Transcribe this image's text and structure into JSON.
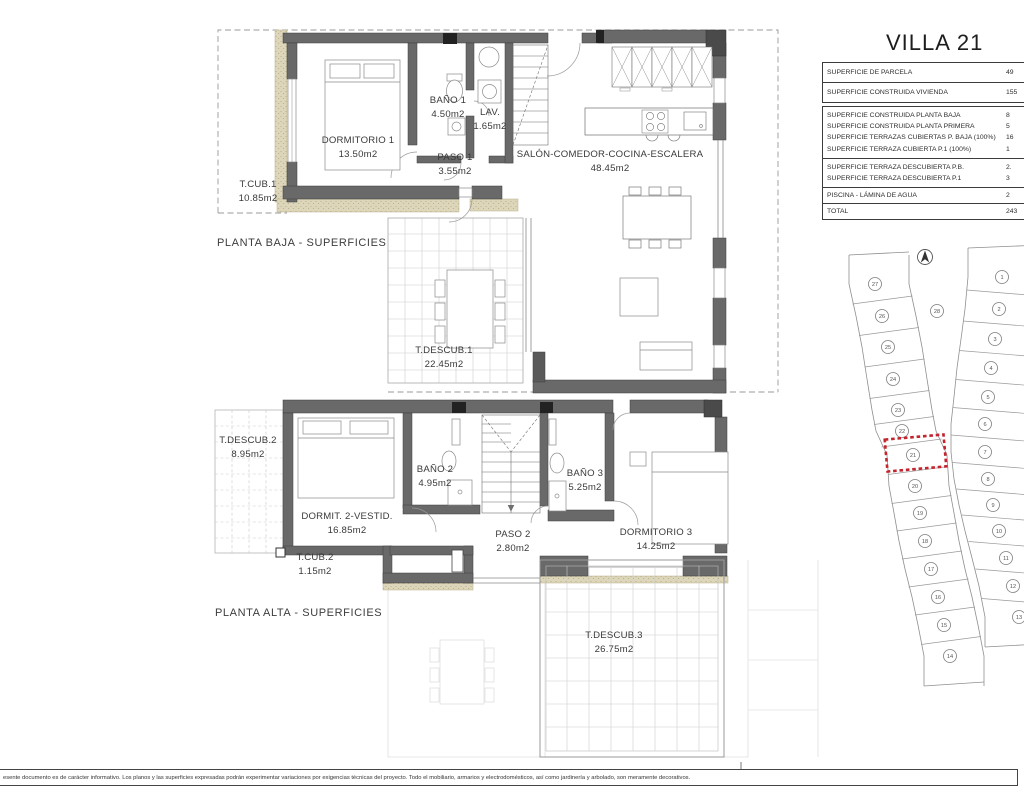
{
  "title": "VILLA 21",
  "table": {
    "rows_main": [
      {
        "label": "SUPERFICIE DE PARCELA",
        "value": "49"
      },
      {
        "label": "SUPERFICIE CONSTRUIDA VIVIENDA",
        "value": "155"
      }
    ],
    "rows_construida": [
      {
        "label": "SUPERFICIE CONSTRUIDA PLANTA BAJA",
        "value": "8"
      },
      {
        "label": "SUPERFICIE CONSTRUIDA PLANTA PRIMERA",
        "value": "5"
      },
      {
        "label": "SUPERFICIE TERRAZAS CUBIERTAS P. BAJA (100%)",
        "value": "16"
      },
      {
        "label": "SUPERFICIE TERRAZA CUBIERTA P.1 (100%)",
        "value": "1"
      }
    ],
    "rows_descubierta": [
      {
        "label": "SUPERFICIE TERRAZA DESCUBIERTA P.B.",
        "value": "2."
      },
      {
        "label": "SUPERFICIE TERRAZA DESCUBIERTA P.1",
        "value": "3"
      }
    ],
    "rows_piscina": [
      {
        "label": "PISCINA - LÁMINA DE AGUA",
        "value": "2"
      }
    ],
    "rows_total": [
      {
        "label": "TOTAL",
        "value": "243"
      }
    ]
  },
  "floors": {
    "baja": {
      "caption": "PLANTA BAJA - SUPERFICIES",
      "rooms": [
        {
          "name": "DORMITORIO 1",
          "area": "13.50m2"
        },
        {
          "name": "BAÑO 1",
          "area": "4.50m2"
        },
        {
          "name": "LAV.",
          "area": "1.65m2"
        },
        {
          "name": "PASO 1",
          "area": "3.55m2"
        },
        {
          "name": "SALÓN-COMEDOR-COCINA-ESCALERA",
          "area": "48.45m2"
        },
        {
          "name": "T.CUB.1",
          "area": "10.85m2"
        },
        {
          "name": "T.DESCUB.1",
          "area": "22.45m2"
        }
      ]
    },
    "alta": {
      "caption": "PLANTA ALTA - SUPERFICIES",
      "rooms": [
        {
          "name": "T.DESCUB.2",
          "area": "8.95m2"
        },
        {
          "name": "DORMIT. 2-VESTID.",
          "area": "16.85m2"
        },
        {
          "name": "BAÑO 2",
          "area": "4.95m2"
        },
        {
          "name": "PASO 2",
          "area": "2.80m2"
        },
        {
          "name": "BAÑO 3",
          "area": "5.25m2"
        },
        {
          "name": "DORMITORIO 3",
          "area": "14.25m2"
        },
        {
          "name": "T.CUB.2",
          "area": "1.15m2"
        },
        {
          "name": "T.DESCUB.3",
          "area": "26.75m2"
        }
      ]
    }
  },
  "site_plan": {
    "north_icon": "north-arrow",
    "highlighted_parcel": "21",
    "parcel_28": {
      "n": "28",
      "x": 937,
      "y": 311
    },
    "left_column": [
      {
        "n": "27",
        "x": 875,
        "y": 284
      },
      {
        "n": "26",
        "x": 882,
        "y": 316
      },
      {
        "n": "25",
        "x": 888,
        "y": 347
      },
      {
        "n": "24",
        "x": 893,
        "y": 379
      },
      {
        "n": "23",
        "x": 898,
        "y": 410
      },
      {
        "n": "22",
        "x": 902,
        "y": 431
      },
      {
        "n": "21",
        "x": 913,
        "y": 455
      },
      {
        "n": "20",
        "x": 915,
        "y": 486
      },
      {
        "n": "19",
        "x": 920,
        "y": 513
      },
      {
        "n": "18",
        "x": 925,
        "y": 541
      },
      {
        "n": "17",
        "x": 931,
        "y": 569
      },
      {
        "n": "16",
        "x": 938,
        "y": 597
      },
      {
        "n": "15",
        "x": 944,
        "y": 625
      },
      {
        "n": "14",
        "x": 950,
        "y": 656
      }
    ],
    "right_column": [
      {
        "n": "1",
        "x": 1002,
        "y": 277
      },
      {
        "n": "2",
        "x": 999,
        "y": 309
      },
      {
        "n": "3",
        "x": 995,
        "y": 339
      },
      {
        "n": "4",
        "x": 991,
        "y": 368
      },
      {
        "n": "5",
        "x": 988,
        "y": 397
      },
      {
        "n": "6",
        "x": 985,
        "y": 424
      },
      {
        "n": "7",
        "x": 985,
        "y": 452
      },
      {
        "n": "8",
        "x": 988,
        "y": 479
      },
      {
        "n": "9",
        "x": 993,
        "y": 505
      },
      {
        "n": "10",
        "x": 999,
        "y": 531
      },
      {
        "n": "11",
        "x": 1006,
        "y": 558
      },
      {
        "n": "12",
        "x": 1013,
        "y": 586
      },
      {
        "n": "13",
        "x": 1019,
        "y": 617
      }
    ]
  },
  "disclaimer": "esente documento es de carácter informativo. Los planos y las superficies expresadas podrán experimentar variaciones por exigencias técnicas del proyecto. Todo el mobiliario, armarios y electrodomésticos, así como jardinería y arbolado, son meramente decorativos.",
  "colors": {
    "wall_gray": "#696969",
    "beige_hatch": "#DDD6BA",
    "highlight_red": "#C2252E"
  }
}
